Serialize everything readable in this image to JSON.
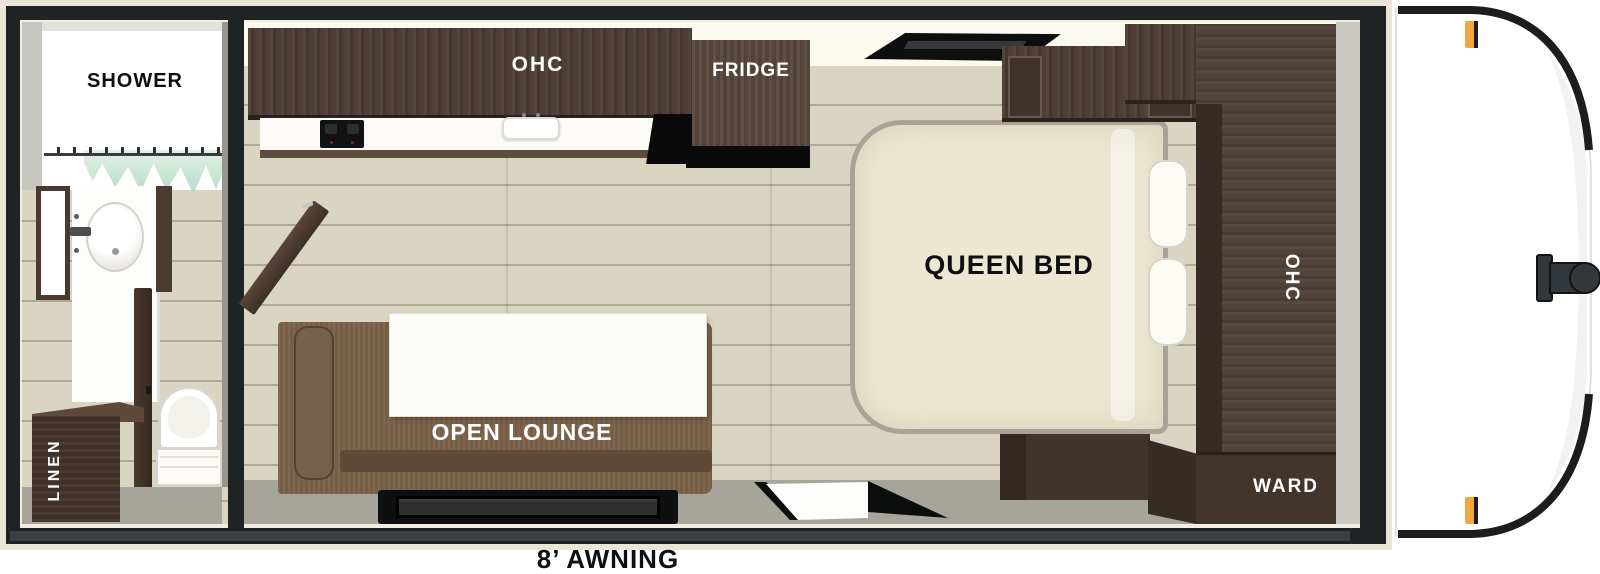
{
  "floorplan": {
    "type": "travel-trailer floor plan",
    "bathroom": {
      "shower_label": "SHOWER",
      "linen_label": "LINEN",
      "fixtures": [
        "shower with curtain",
        "mirror",
        "sink vanity",
        "toilet",
        "linen cabinet",
        "door"
      ]
    },
    "kitchen": {
      "overhead_cabinet_label": "OHC",
      "fridge_label": "FRIDGE",
      "fixtures": [
        "two-burner cooktop",
        "sink",
        "counter"
      ]
    },
    "lounge": {
      "label": "OPEN LOUNGE",
      "fixtures": [
        "sofa",
        "table",
        "entry step",
        "entry door"
      ]
    },
    "bedroom": {
      "bed_label": "QUEEN BED",
      "wardrobe_front_label": "WARD",
      "overhead_cabinet_label": "OHC",
      "wardrobe_rear_label": "WARD",
      "fixtures": [
        "queen bed",
        "pillows",
        "overhead cabinets",
        "window",
        "bed-foot cabinet"
      ]
    },
    "exterior": {
      "awning_label": "8’ AWNING",
      "features": [
        "front cap",
        "hitch coupler",
        "marker lights"
      ]
    }
  },
  "colors": {
    "wall_black": "#202324",
    "frame_trim_cream": "#eae6d7",
    "floor_beige": "#d9d5c2",
    "walkway_gray": "#a7a49c",
    "cabinet_wood_dark": "#4a3a31",
    "sofa_brown": "#7b6349",
    "mattress_cream": "#ece7d3",
    "curtain_teal": "#b7dbc7",
    "marker_light_orange": "#f3a63c",
    "awning_bar_gray": "#3b3f42"
  }
}
